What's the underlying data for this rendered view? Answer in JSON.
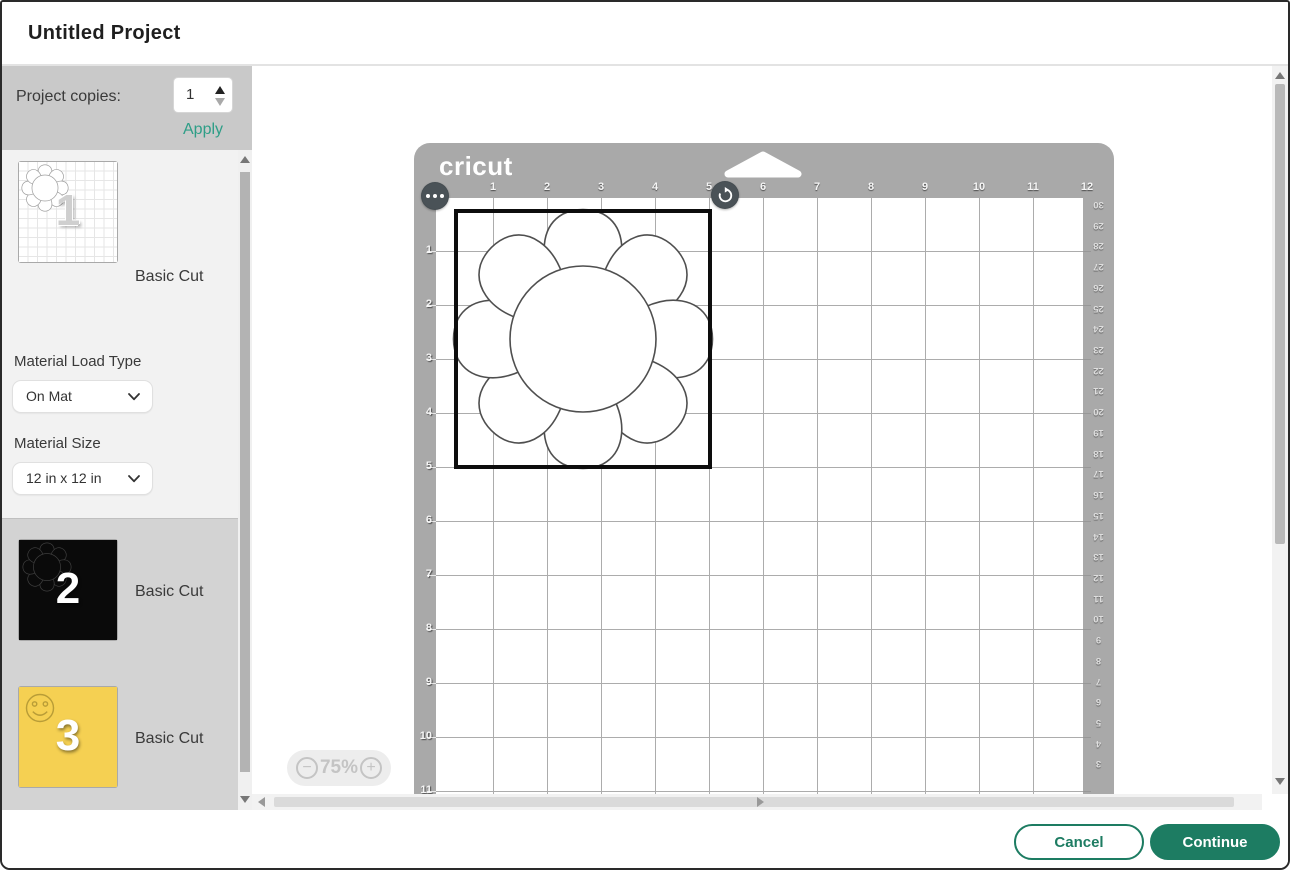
{
  "header": {
    "title": "Untitled Project"
  },
  "sidebar": {
    "project_copies": {
      "label": "Project copies:",
      "value": "1",
      "apply_label": "Apply"
    },
    "material_load_type": {
      "label": "Material Load Type",
      "value": "On Mat"
    },
    "material_size": {
      "label": "Material Size",
      "value": "12 in x 12 in"
    },
    "mirror": {
      "label": "Mirror",
      "enabled": false
    },
    "mats": [
      {
        "number": "1",
        "label": "Basic Cut",
        "material_color": "white"
      },
      {
        "number": "2",
        "label": "Basic Cut",
        "material_color": "black"
      },
      {
        "number": "3",
        "label": "Basic Cut",
        "material_color": "yellow"
      }
    ]
  },
  "canvas": {
    "brand": "cricut",
    "zoom_level": "75%",
    "rulers": {
      "top_inches": [
        "1",
        "2",
        "3",
        "4",
        "5",
        "6",
        "7",
        "8",
        "9",
        "10",
        "11",
        "12"
      ],
      "left_inches": [
        "1",
        "2",
        "3",
        "4",
        "5",
        "6",
        "7",
        "8",
        "9",
        "10",
        "11"
      ],
      "right_cm": [
        "30",
        "29",
        "28",
        "27",
        "26",
        "25",
        "24",
        "23",
        "22",
        "21",
        "20",
        "19",
        "18",
        "17",
        "16",
        "15",
        "14",
        "13",
        "12",
        "11",
        "10",
        "9",
        "8",
        "7",
        "6",
        "5",
        "4",
        "3"
      ]
    }
  },
  "footer": {
    "cancel_label": "Cancel",
    "continue_label": "Continue"
  },
  "colors": {
    "brand_green": "#1d7c62",
    "apply_teal": "#2e9e87",
    "mat_gray": "#a9a9a9",
    "selection_black": "#0d0d0d",
    "mat3_yellow": "#f5d052"
  }
}
